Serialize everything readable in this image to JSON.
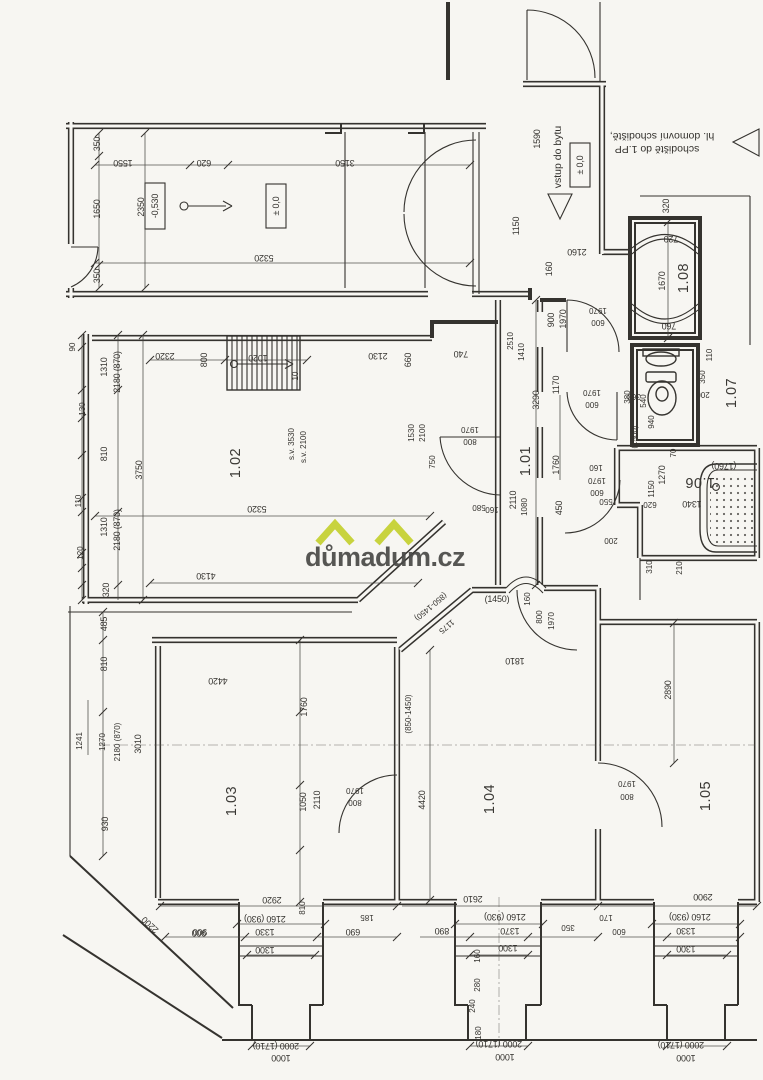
{
  "page": {
    "bg": "#f7f6f2",
    "ink": "#35332f"
  },
  "watermark": {
    "text": "důmadum.cz",
    "color": "#4a4a48",
    "roof_color": "#c5d134"
  },
  "rooms": [
    "1.01",
    "1.02",
    "1.03",
    "1.04",
    "1.05",
    "1.06",
    "1.07",
    "1.08"
  ],
  "annotations": {
    "entry": "vstup do bytu",
    "level_zero": "± 0,0",
    "level_minus": "-0,530",
    "stairs1": "hl. domovní schodiště,",
    "stairs2": "schodiště do 1.PP",
    "sv1": "s.v. 3530",
    "sv2": "s.v. 2100",
    "stair_count": "10"
  },
  "dims": {
    "corridor": [
      "350",
      "1550",
      "620",
      "1650",
      "2350",
      "350",
      "5320",
      "3150"
    ],
    "entry": [
      "1590",
      "1150",
      "2160",
      "160"
    ],
    "r108": [
      "320",
      "720",
      "1670",
      "760"
    ],
    "spine": [
      "2130",
      "660",
      "740",
      "2510",
      "1410",
      "900",
      "1970",
      "1970",
      "600",
      "1170",
      "3290",
      "1970",
      "600",
      "360",
      "1760",
      "160",
      "1970",
      "600",
      "550",
      "450",
      "2110",
      "1080",
      "160",
      "580",
      "1810"
    ],
    "wc": [
      "110",
      "350",
      "200",
      "380",
      "540",
      "940",
      "(1500)",
      "70"
    ],
    "bath": [
      "1270",
      "1150",
      "620",
      "1340",
      "(1760)",
      "310",
      "210",
      "200"
    ],
    "r102": [
      "90",
      "1310",
      "2180 (870)",
      "130",
      "810",
      "3750",
      "110",
      "1310",
      "2180 (870)",
      "120",
      "320",
      "2320",
      "800",
      "1020",
      "5320",
      "4130",
      "1530",
      "2100",
      "750",
      "1970",
      "800"
    ],
    "left": [
      "485",
      "810",
      "1241",
      "1270",
      "2180 (870)",
      "3010",
      "930",
      "2200",
      "900",
      "4420"
    ],
    "r103": [
      "1760",
      "1050",
      "2110",
      "1970",
      "800"
    ],
    "r104": [
      "(850-1450)",
      "1175",
      "(1450)",
      "(850-1450)",
      "160",
      "800",
      "1970",
      "4420"
    ],
    "r105": [
      "2890",
      "1970",
      "800"
    ],
    "bayL": [
      "2920",
      "2160 (930)",
      "1330",
      "1300",
      "900",
      "690",
      "185",
      "810",
      "2000 (1710)",
      "1000"
    ],
    "bayC": [
      "2610",
      "2160 (930)",
      "1370",
      "1300",
      "890",
      "350",
      "160",
      "280",
      "240",
      "180",
      "2000 (1710)",
      "1000",
      "170",
      "600"
    ],
    "bayR": [
      "2900",
      "2160 (930)",
      "1330",
      "1300",
      "2000 (1710)",
      "1000"
    ]
  }
}
